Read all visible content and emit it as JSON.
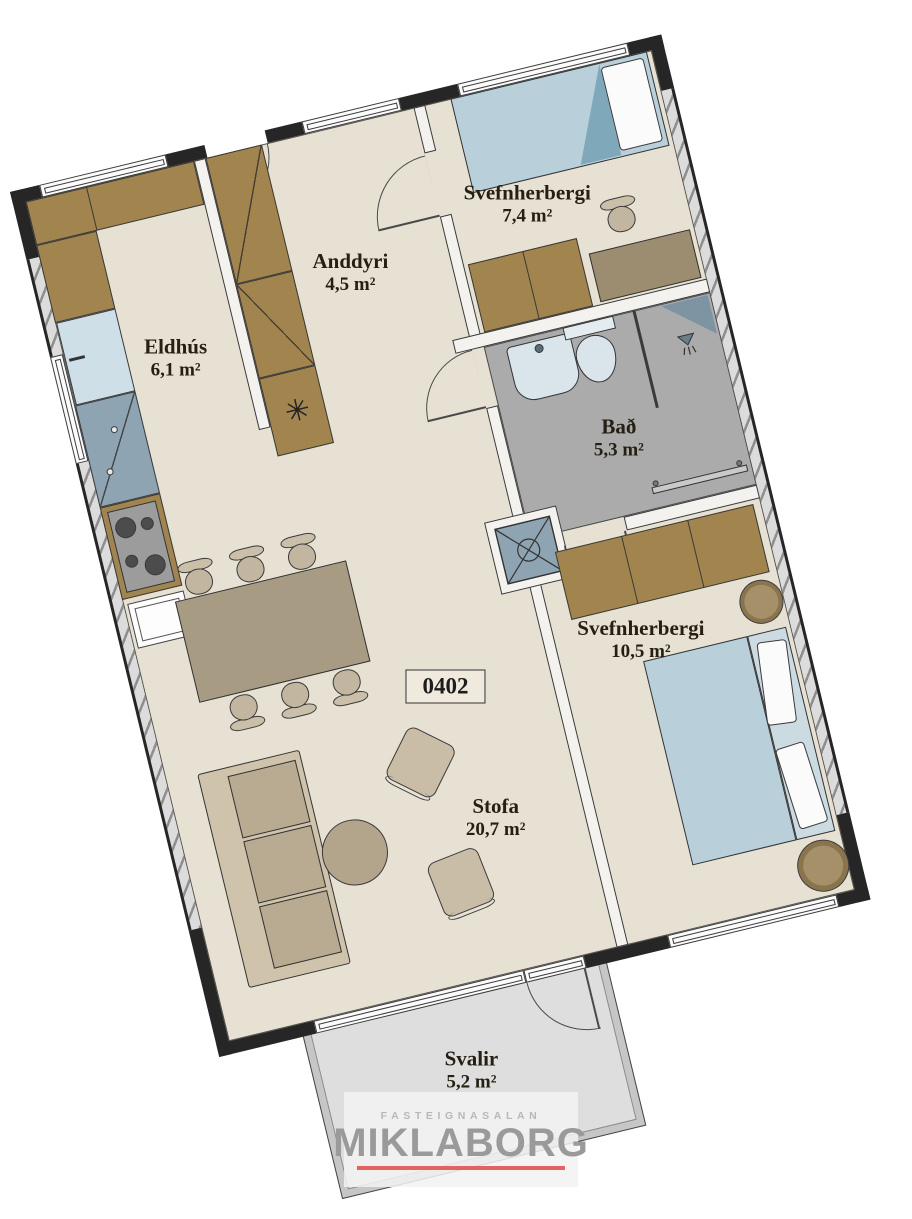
{
  "meta": {
    "apartment_number": "0402"
  },
  "rooms": [
    {
      "id": "eldhus",
      "name": "Eldhús",
      "area": "6,1 m²"
    },
    {
      "id": "anddyri",
      "name": "Anddyri",
      "area": "4,5 m²"
    },
    {
      "id": "bedroom1",
      "name": "Svefnherbergi",
      "area": "7,4 m²"
    },
    {
      "id": "bad",
      "name": "Bað",
      "area": "5,3 m²"
    },
    {
      "id": "bedroom2",
      "name": "Svefnherbergi",
      "area": "10,5 m²"
    },
    {
      "id": "stofa",
      "name": "Stofa",
      "area": "20,7 m²"
    },
    {
      "id": "svalir",
      "name": "Svalir",
      "area": "5,2 m²"
    }
  ],
  "watermark": {
    "brand_top": "FASTEIGNASALAN",
    "brand": "MIKLABORG"
  },
  "icons": {
    "closet_symbol": "✳"
  },
  "colors": {
    "floor_beige": "#e6e1d3",
    "bathroom_floor": "#ababab",
    "balcony_floor": "#dedede",
    "furniture_brown": "#a2854e",
    "bed_blue": "#b9cfda",
    "steel_blue": "#8fa4b2",
    "wall_black": "#262626",
    "logo_gray": "#9a9a9a",
    "accent_red": "#e4625f"
  }
}
